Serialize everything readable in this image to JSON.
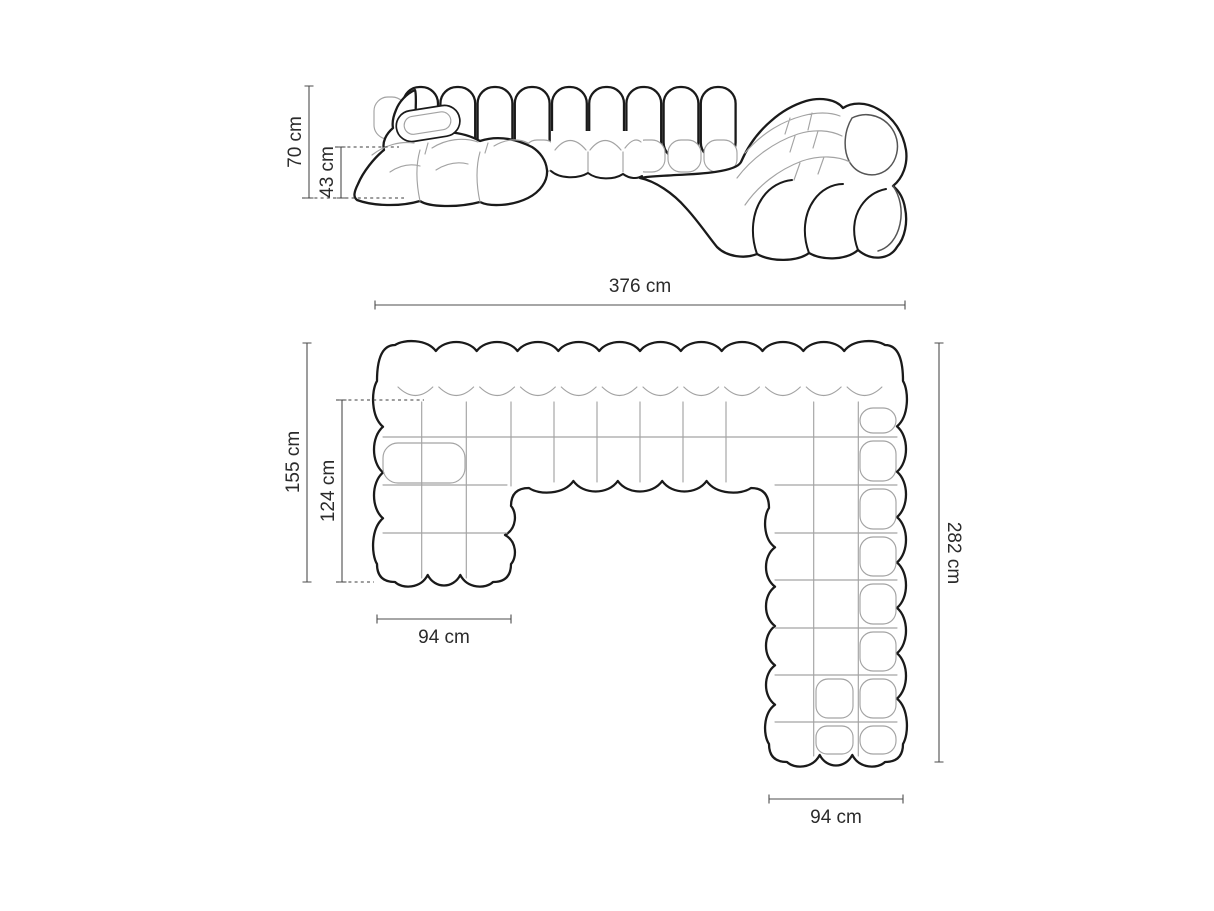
{
  "diagram": {
    "unit": "cm",
    "views": {
      "front": {
        "label": "front-elevation",
        "dims": {
          "total_height": "70 cm",
          "seat_height": "43 cm"
        }
      },
      "plan": {
        "label": "top-plan",
        "dims": {
          "total_width": "376 cm",
          "left_side_depth": "155 cm",
          "left_inner_depth": "124 cm",
          "left_module_width": "94 cm",
          "right_side_depth": "282 cm",
          "right_module_width": "94 cm"
        }
      }
    },
    "colors": {
      "outline": "#1a1a1a",
      "seam": "#a3a3a3",
      "dimension_line": "#4d4d4d",
      "label_text": "#2b2b2b",
      "background": "#ffffff"
    }
  }
}
